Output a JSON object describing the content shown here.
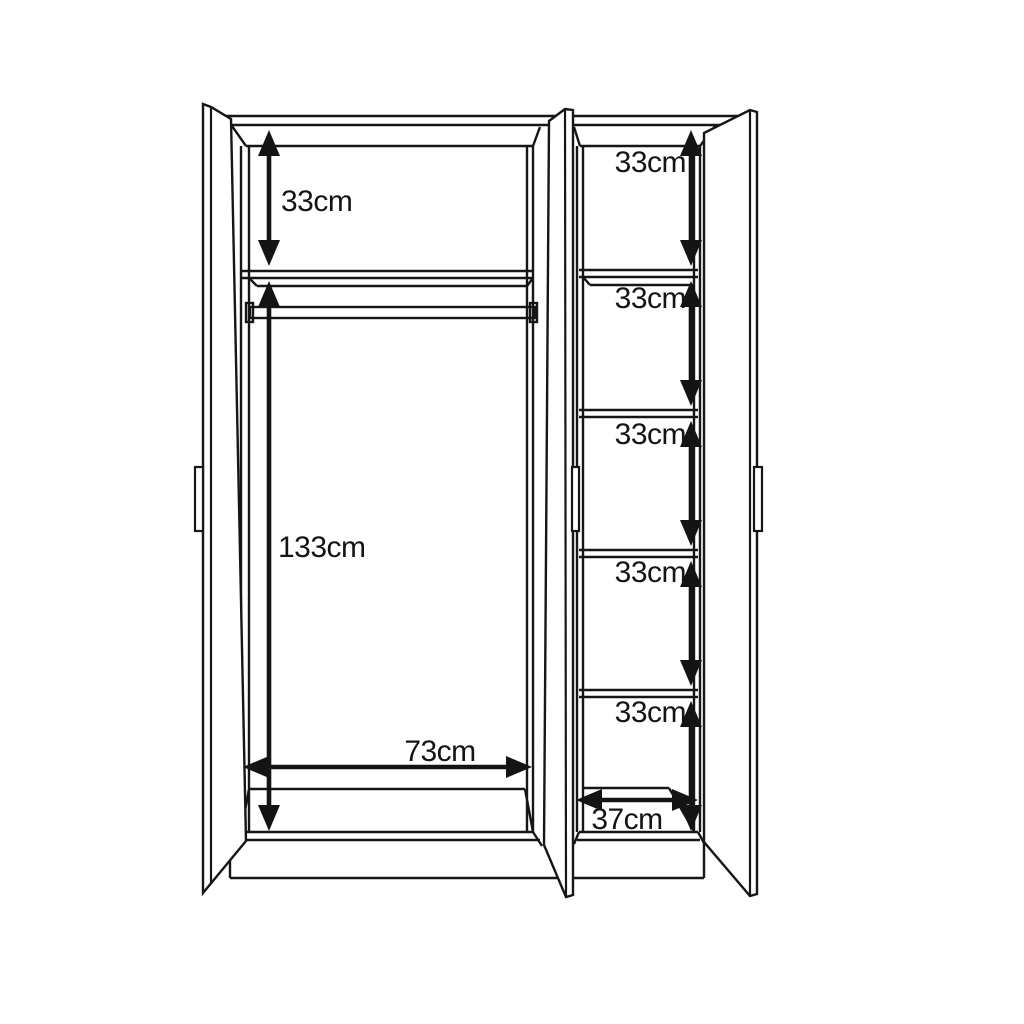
{
  "diagram": {
    "type": "wardrobe-technical-drawing",
    "background": "#ffffff",
    "line_color": "#161616",
    "left_section": {
      "top_shelf_height": "33cm",
      "hanging_space_height": "133cm",
      "width": "73cm"
    },
    "right_section": {
      "shelf_heights": [
        "33cm",
        "33cm",
        "33cm",
        "33cm",
        "33cm"
      ],
      "width": "37cm"
    }
  }
}
